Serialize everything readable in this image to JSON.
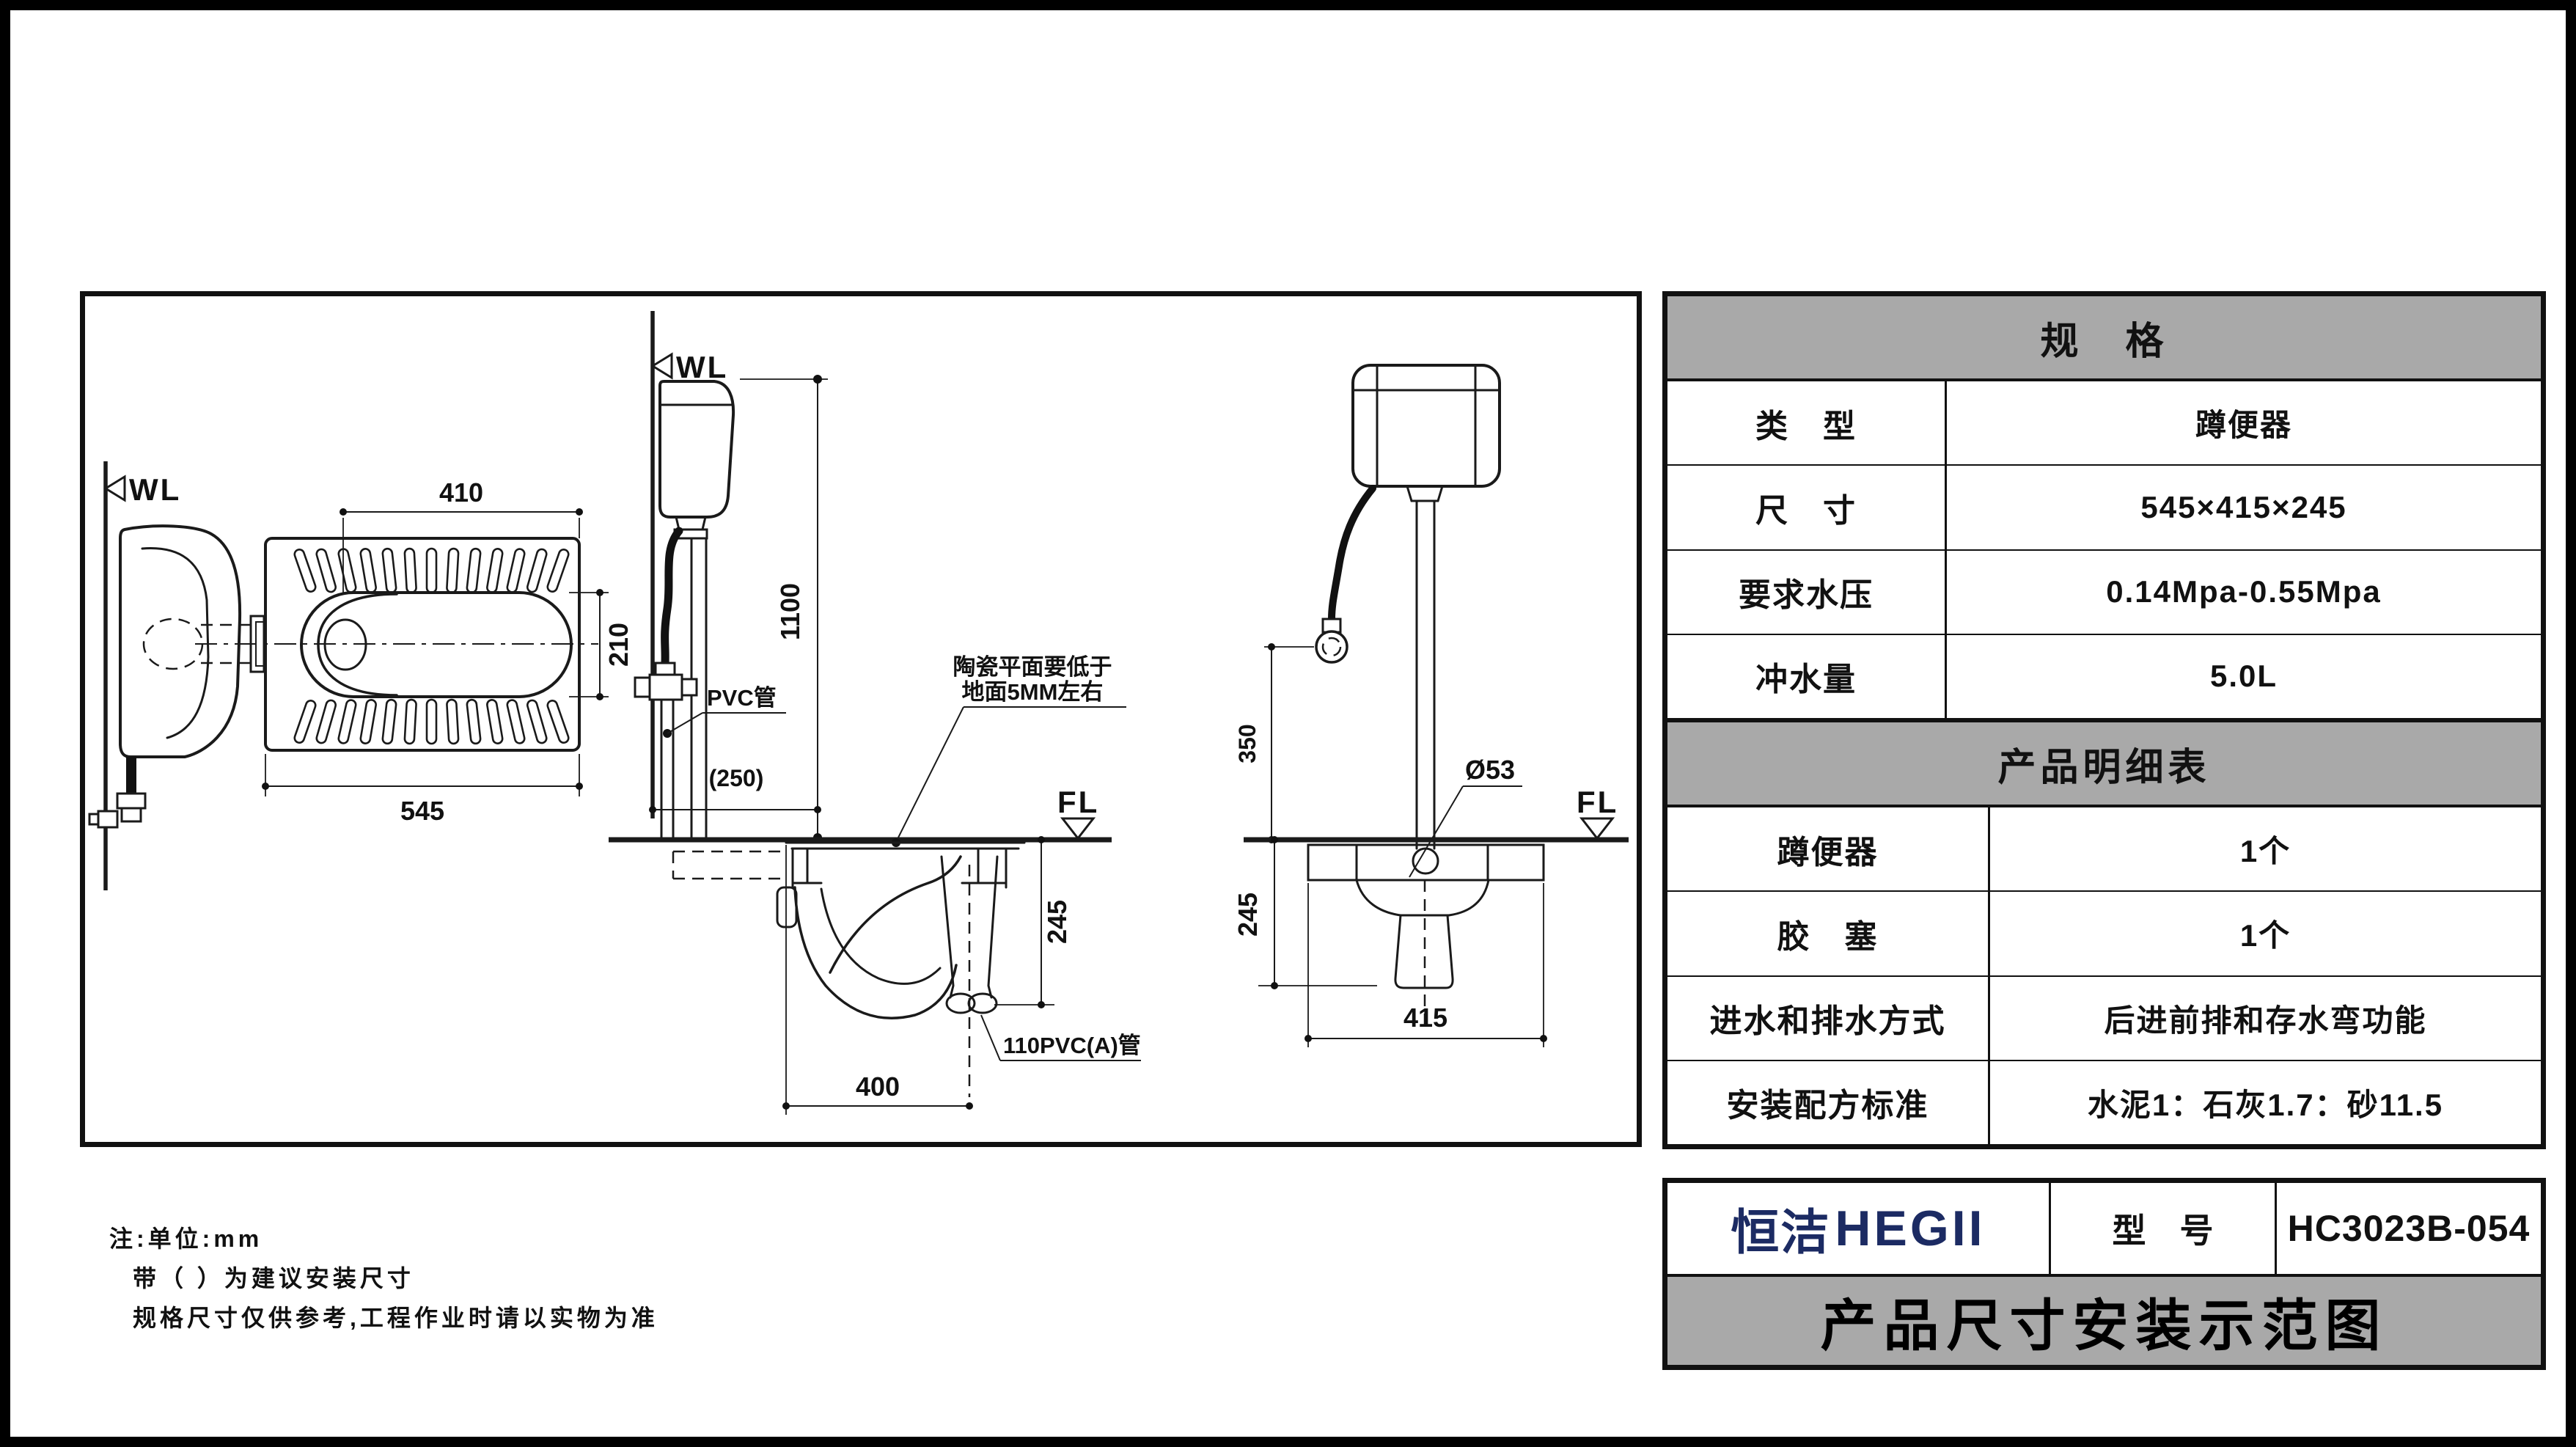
{
  "plan_view": {
    "wl_label": "WL",
    "dim_top": "410",
    "dim_bowl_width": "210",
    "dim_length": "545"
  },
  "side_view": {
    "wl_label": "WL",
    "dim_tank_height": "1100",
    "dim_wall_offset": "(250)",
    "pvc_pipe_label": "PVC管",
    "ceramic_note_line1": "陶瓷平面要低于",
    "ceramic_note_line2": "地面5MM左右",
    "fl_label": "FL",
    "dim_depth": "245",
    "dim_outlet_offset": "400",
    "outlet_pipe_label": "110PVC(A)管"
  },
  "front_view": {
    "dim_inlet_height": "350",
    "dim_flush_pipe_dia": "Ø53",
    "fl_label": "FL",
    "dim_depth": "245",
    "dim_width": "415"
  },
  "notes": {
    "line1": "注:单位:mm",
    "line2": "带（ ）为建议安装尺寸",
    "line3": "规格尺寸仅供参考,工程作业时请以实物为准"
  },
  "spec_table": {
    "header": "规　格",
    "rows": [
      {
        "label": "类　型",
        "value": "蹲便器"
      },
      {
        "label": "尺　寸",
        "value": "545×415×245"
      },
      {
        "label": "要求水压",
        "value": "0.14Mpa-0.55Mpa"
      },
      {
        "label": "冲水量",
        "value": "5.0L"
      }
    ]
  },
  "detail_table": {
    "header": "产品明细表",
    "rows": [
      {
        "label": "蹲便器",
        "value": "1个"
      },
      {
        "label": "胶　塞",
        "value": "1个"
      },
      {
        "label": "进水和排水方式",
        "value": "后进前排和存水弯功能"
      },
      {
        "label": "安装配方标准",
        "value": "水泥1：石灰1.7：砂11.5"
      }
    ]
  },
  "title_block": {
    "brand_cn": "恒洁",
    "brand_en": "HEGII",
    "model_label": "型　号",
    "model_value": "HC3023B-054",
    "title": "产品尺寸安装示范图"
  },
  "colors": {
    "brand_navy": "#1c2b63",
    "table_header_gray": "#a9a9a9",
    "line_black": "#1a1a1a"
  }
}
